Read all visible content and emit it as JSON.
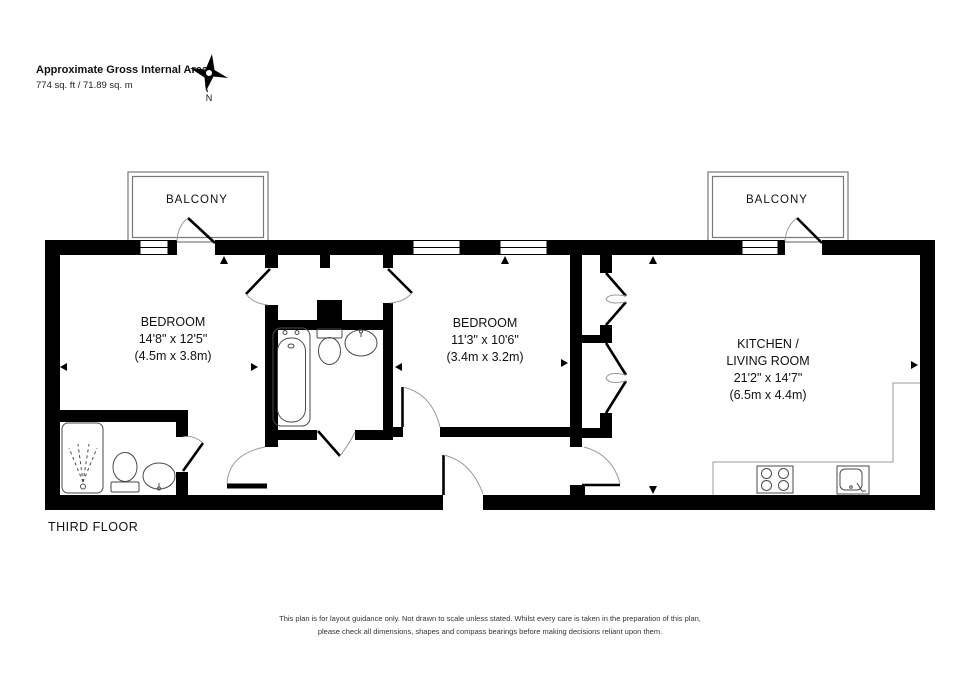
{
  "header": {
    "title": "Approximate Gross Internal Area",
    "area": "774 sq. ft / 71.89 sq. m"
  },
  "compass": {
    "north_label": "N"
  },
  "floor_label": "THIRD FLOOR",
  "rooms": {
    "balcony_left": {
      "name": "BALCONY"
    },
    "balcony_right": {
      "name": "BALCONY"
    },
    "bedroom1": {
      "name": "BEDROOM",
      "imperial": "14'8\" x 12'5\"",
      "metric": "(4.5m x 3.8m)"
    },
    "bedroom2": {
      "name": "BEDROOM",
      "imperial": "11'3\" x 10'6\"",
      "metric": "(3.4m x 3.2m)"
    },
    "kitchen_living": {
      "name_line1": "KITCHEN /",
      "name_line2": "LIVING ROOM",
      "imperial": "21'2\" x 14'7\"",
      "metric": "(6.5m x 4.4m)"
    }
  },
  "fixtures": [
    "bathtub",
    "toilet",
    "basin",
    "shower",
    "toilet",
    "basin",
    "hob",
    "kitchen-sink"
  ],
  "disclaimer": {
    "line1": "This plan is for layout guidance only. Not drawn to scale unless stated. Whilst every care is taken in the preparation of this plan,",
    "line2": "please check all dimensions, shapes and compass bearings before making decisions reliant upon them."
  },
  "colors": {
    "wall": "#000000",
    "background": "#ffffff",
    "balcony_line": "#787878",
    "door_arc": "#9b9b9b",
    "fixture_line": "#4a4a4a",
    "text": "#111111"
  }
}
